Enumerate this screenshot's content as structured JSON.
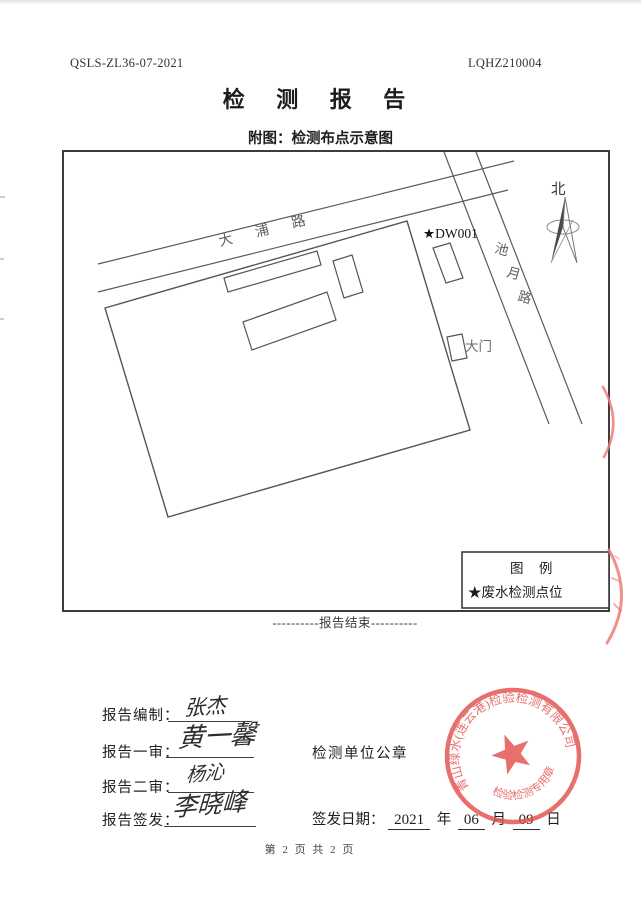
{
  "header": {
    "code_left": "QSLS-ZL36-07-2021",
    "code_right": "LQHZ210004",
    "title": "检 测 报 告",
    "subtitle": "附图：检测布点示意图"
  },
  "diagram": {
    "road_dapu": "大  浦  路",
    "road_chiyue": [
      "池",
      "月",
      "路"
    ],
    "north_label": "北",
    "point_label": "★DW001",
    "gate_label": "大门",
    "legend": {
      "title": "图  例",
      "item": "★废水检测点位"
    }
  },
  "footer": {
    "end_marker": "----------报告结束----------",
    "page_info": "第 2 页 共 2 页"
  },
  "signoff": {
    "rows": [
      {
        "label": "报告编制：",
        "signature": "张杰"
      },
      {
        "label": "报告一审：",
        "signature": "黄一馨"
      },
      {
        "label": "报告二审：",
        "signature": "杨沁"
      },
      {
        "label": "报告签发：",
        "signature": "李晓峰"
      }
    ],
    "seal_caption": "检测单位公章",
    "date": {
      "label": "签发日期：",
      "year": "2021",
      "year_unit": "年",
      "month": "06",
      "month_unit": "月",
      "day": "09",
      "day_unit": "日"
    }
  },
  "seal": {
    "company": "青山绿水(连云港)检验检测有限公司",
    "stamp_type": "检验检测专用章",
    "color": "#e2514d"
  }
}
